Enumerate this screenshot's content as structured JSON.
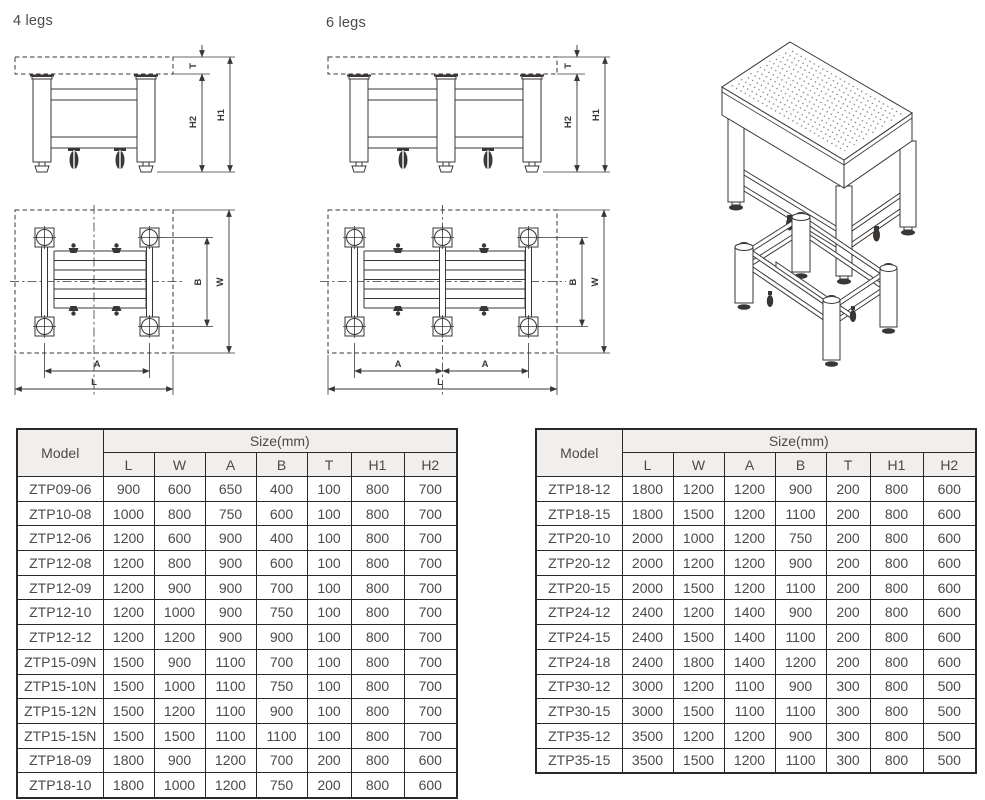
{
  "labels": {
    "four_legs": "4 legs",
    "six_legs": "6 legs"
  },
  "dims": {
    "T": "T",
    "H1": "H1",
    "H2": "H2",
    "A": "A",
    "B": "B",
    "L": "L",
    "W": "W"
  },
  "colors": {
    "line": "#3a3634",
    "text": "#4c4a48",
    "table_border": "#2b2927",
    "header_bg": "#f0efed",
    "page_bg": "#ffffff"
  },
  "spec_tables": {
    "header": {
      "model": "Model",
      "size_group": "Size(mm)"
    },
    "left": {
      "columns": [
        "L",
        "W",
        "A",
        "B",
        "T",
        "H1",
        "H2"
      ],
      "rows": [
        {
          "model": "ZTP09-06",
          "values": [
            "900",
            "600",
            "650",
            "400",
            "100",
            "800",
            "700"
          ]
        },
        {
          "model": "ZTP10-08",
          "values": [
            "1000",
            "800",
            "750",
            "600",
            "100",
            "800",
            "700"
          ]
        },
        {
          "model": "ZTP12-06",
          "values": [
            "1200",
            "600",
            "900",
            "400",
            "100",
            "800",
            "700"
          ]
        },
        {
          "model": "ZTP12-08",
          "values": [
            "1200",
            "800",
            "900",
            "600",
            "100",
            "800",
            "700"
          ]
        },
        {
          "model": "ZTP12-09",
          "values": [
            "1200",
            "900",
            "900",
            "700",
            "100",
            "800",
            "700"
          ]
        },
        {
          "model": "ZTP12-10",
          "values": [
            "1200",
            "1000",
            "900",
            "750",
            "100",
            "800",
            "700"
          ]
        },
        {
          "model": "ZTP12-12",
          "values": [
            "1200",
            "1200",
            "900",
            "900",
            "100",
            "800",
            "700"
          ]
        },
        {
          "model": "ZTP15-09N",
          "values": [
            "1500",
            "900",
            "1100",
            "700",
            "100",
            "800",
            "700"
          ]
        },
        {
          "model": "ZTP15-10N",
          "values": [
            "1500",
            "1000",
            "1100",
            "750",
            "100",
            "800",
            "700"
          ]
        },
        {
          "model": "ZTP15-12N",
          "values": [
            "1500",
            "1200",
            "1100",
            "900",
            "100",
            "800",
            "700"
          ]
        },
        {
          "model": "ZTP15-15N",
          "values": [
            "1500",
            "1500",
            "1100",
            "1100",
            "100",
            "800",
            "700"
          ]
        },
        {
          "model": "ZTP18-09",
          "values": [
            "1800",
            "900",
            "1200",
            "700",
            "200",
            "800",
            "600"
          ]
        },
        {
          "model": "ZTP18-10",
          "values": [
            "1800",
            "1000",
            "1200",
            "750",
            "200",
            "800",
            "600"
          ]
        }
      ]
    },
    "right": {
      "columns": [
        "L",
        "W",
        "A",
        "B",
        "T",
        "H1",
        "H2"
      ],
      "rows": [
        {
          "model": "ZTP18-12",
          "values": [
            "1800",
            "1200",
            "1200",
            "900",
            "200",
            "800",
            "600"
          ]
        },
        {
          "model": "ZTP18-15",
          "values": [
            "1800",
            "1500",
            "1200",
            "1100",
            "200",
            "800",
            "600"
          ]
        },
        {
          "model": "ZTP20-10",
          "values": [
            "2000",
            "1000",
            "1200",
            "750",
            "200",
            "800",
            "600"
          ]
        },
        {
          "model": "ZTP20-12",
          "values": [
            "2000",
            "1200",
            "1200",
            "900",
            "200",
            "800",
            "600"
          ]
        },
        {
          "model": "ZTP20-15",
          "values": [
            "2000",
            "1500",
            "1200",
            "1100",
            "200",
            "800",
            "600"
          ]
        },
        {
          "model": "ZTP24-12",
          "values": [
            "2400",
            "1200",
            "1400",
            "900",
            "200",
            "800",
            "600"
          ]
        },
        {
          "model": "ZTP24-15",
          "values": [
            "2400",
            "1500",
            "1400",
            "1100",
            "200",
            "800",
            "600"
          ]
        },
        {
          "model": "ZTP24-18",
          "values": [
            "2400",
            "1800",
            "1400",
            "1200",
            "200",
            "800",
            "600"
          ]
        },
        {
          "model": "ZTP30-12",
          "values": [
            "3000",
            "1200",
            "1100",
            "900",
            "300",
            "800",
            "500"
          ]
        },
        {
          "model": "ZTP30-15",
          "values": [
            "3000",
            "1500",
            "1100",
            "1100",
            "300",
            "800",
            "500"
          ]
        },
        {
          "model": "ZTP35-12",
          "values": [
            "3500",
            "1200",
            "1200",
            "900",
            "300",
            "800",
            "500"
          ]
        },
        {
          "model": "ZTP35-15",
          "values": [
            "3500",
            "1500",
            "1200",
            "1100",
            "300",
            "800",
            "500"
          ]
        }
      ]
    }
  }
}
